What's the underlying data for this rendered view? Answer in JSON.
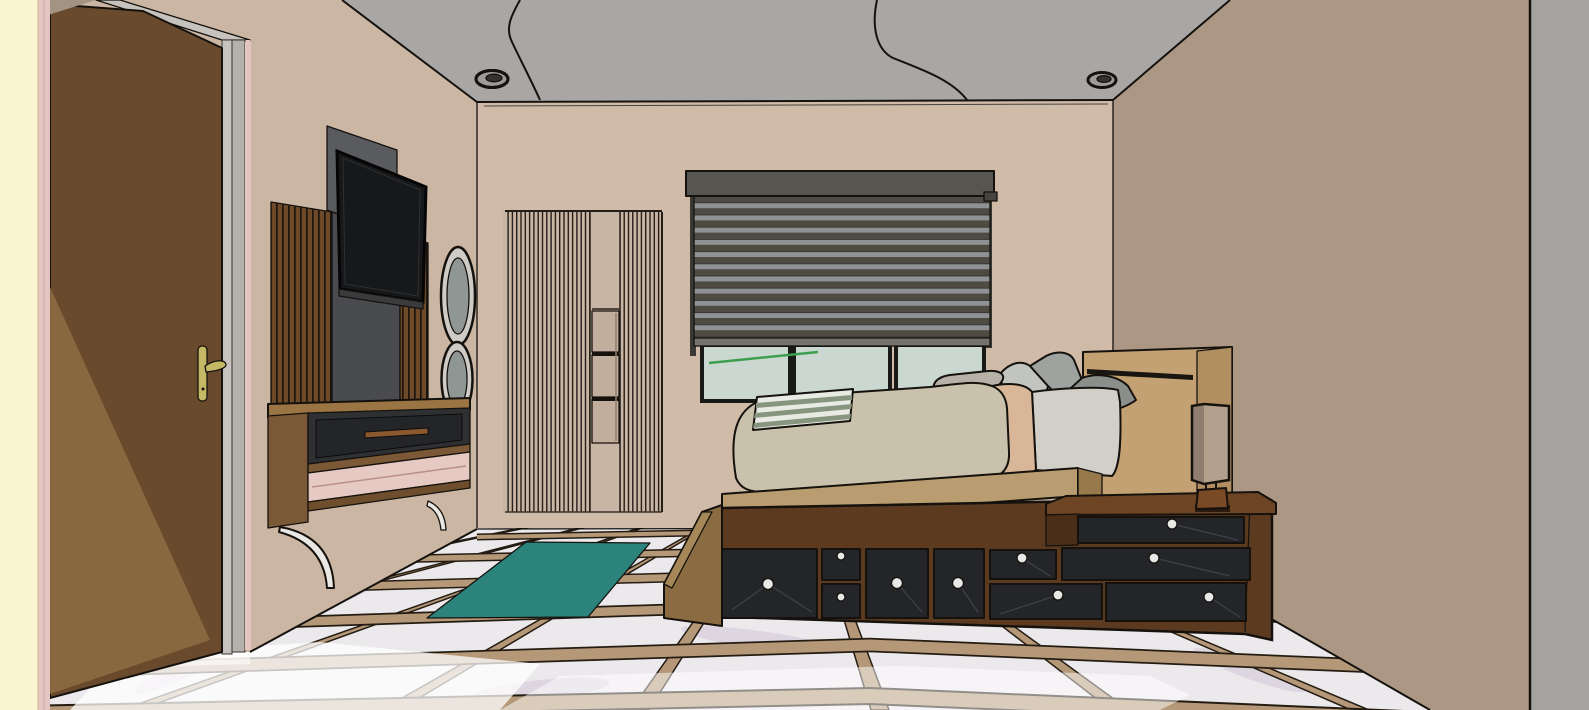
{
  "scene": {
    "description": "3D rendered bedroom interior, sketch-style (SketchUp-like), one-point perspective toward back wall",
    "objects": [
      "open entry door with gold handle",
      "cream outer wall strip",
      "wall-mounted TV on slatted feature wall",
      "floating media console with drawer and pink shelf",
      "two oval wall mirrors",
      "fluted wall panel with three display niches",
      "window with zebra roller blind and three panes",
      "green stem line on window glass",
      "platform storage bed with black drawers and white knobs",
      "wood headboard with groove",
      "integrated nightstand with drawers",
      "rectangular bedside lamp",
      "bed step",
      "teal area rug",
      "marble tile floor with wood inlay grid",
      "two recessed ceiling lights",
      "two ceiling cables",
      "gray camera cut plane at right edge"
    ]
  },
  "palette": {
    "edge": "#15120E",
    "ceiling": "#A9A7A5",
    "wallLeft": "#CBB5A3",
    "wallBack": "#D0BAA8",
    "wallRight": "#AB9783",
    "grayStrip": "#A5A3A1",
    "cream": "#FBF4D0",
    "pinkTrim": "#E3C6C1",
    "jamb": "#C6C2BE",
    "jambDark": "#B5B1AD",
    "doorWood": "#6A4A2C",
    "doorLight": "#8D6C42",
    "gold": "#C5B966",
    "slatWood": "#6F4A28",
    "panelGray": "#4A4B4E",
    "panelGrayLight": "#5A5B5E",
    "tvBlack": "#17181A",
    "mirrorFrame": "#CFCBC7",
    "mirrorGlass": "#8E9794",
    "consoleTop": "#9A7442",
    "consoleWood": "#7B5936",
    "consoleBottom": "#6E4E2C",
    "openingDark": "#2F3032",
    "drawerDark": "#242528",
    "knob": "#E8E8E6",
    "handleWood": "#8A5A2E",
    "shelfPink": "#E7C9C3",
    "bracket": "#EAE8E4",
    "flutePanel": "#C9B5A4",
    "fluteLine": "#241E18",
    "niche": "#C2AE9D",
    "valance": "#56554F",
    "blindDark": "#4E4B42",
    "blindLight": "#8E9295",
    "rail": "#3B3934",
    "blindBar": "#74736D",
    "glass": "#CBD8D2",
    "green": "#3E9E4F",
    "duvet": "#C9C1AB",
    "sheetPink": "#D9B698",
    "mattressGray": "#D2CFC8",
    "pillowLight": "#C2C4C0",
    "pillowMid": "#9FA3A0",
    "pillowDark": "#8A8F8C",
    "blanketWhite": "#E8EBE4",
    "blanketSage": "#87957F",
    "headboard": "#C4A173",
    "headboardSide": "#B28F60",
    "slabWood": "#B99C6F",
    "slabSide": "#97794C",
    "baseWood": "#5B3A20",
    "baseDark": "#4A2E18",
    "nightstand": "#6E4524",
    "nightstandTop": "#8A5A32",
    "lampShade": "#B3A18D",
    "lampShadeDark": "#8F7E6F",
    "lampBase": "#7A4A26",
    "floorTile": "#ECE9EC",
    "floorStrip": "#B59877",
    "stripEdge": "#241C12",
    "rug": "#2B837C",
    "sun": "#FFFFFF",
    "stepSide": "#8A6B42",
    "stepTop": "#A68757",
    "vein": "#C9BAD2",
    "cornerTri": "#A39382"
  }
}
